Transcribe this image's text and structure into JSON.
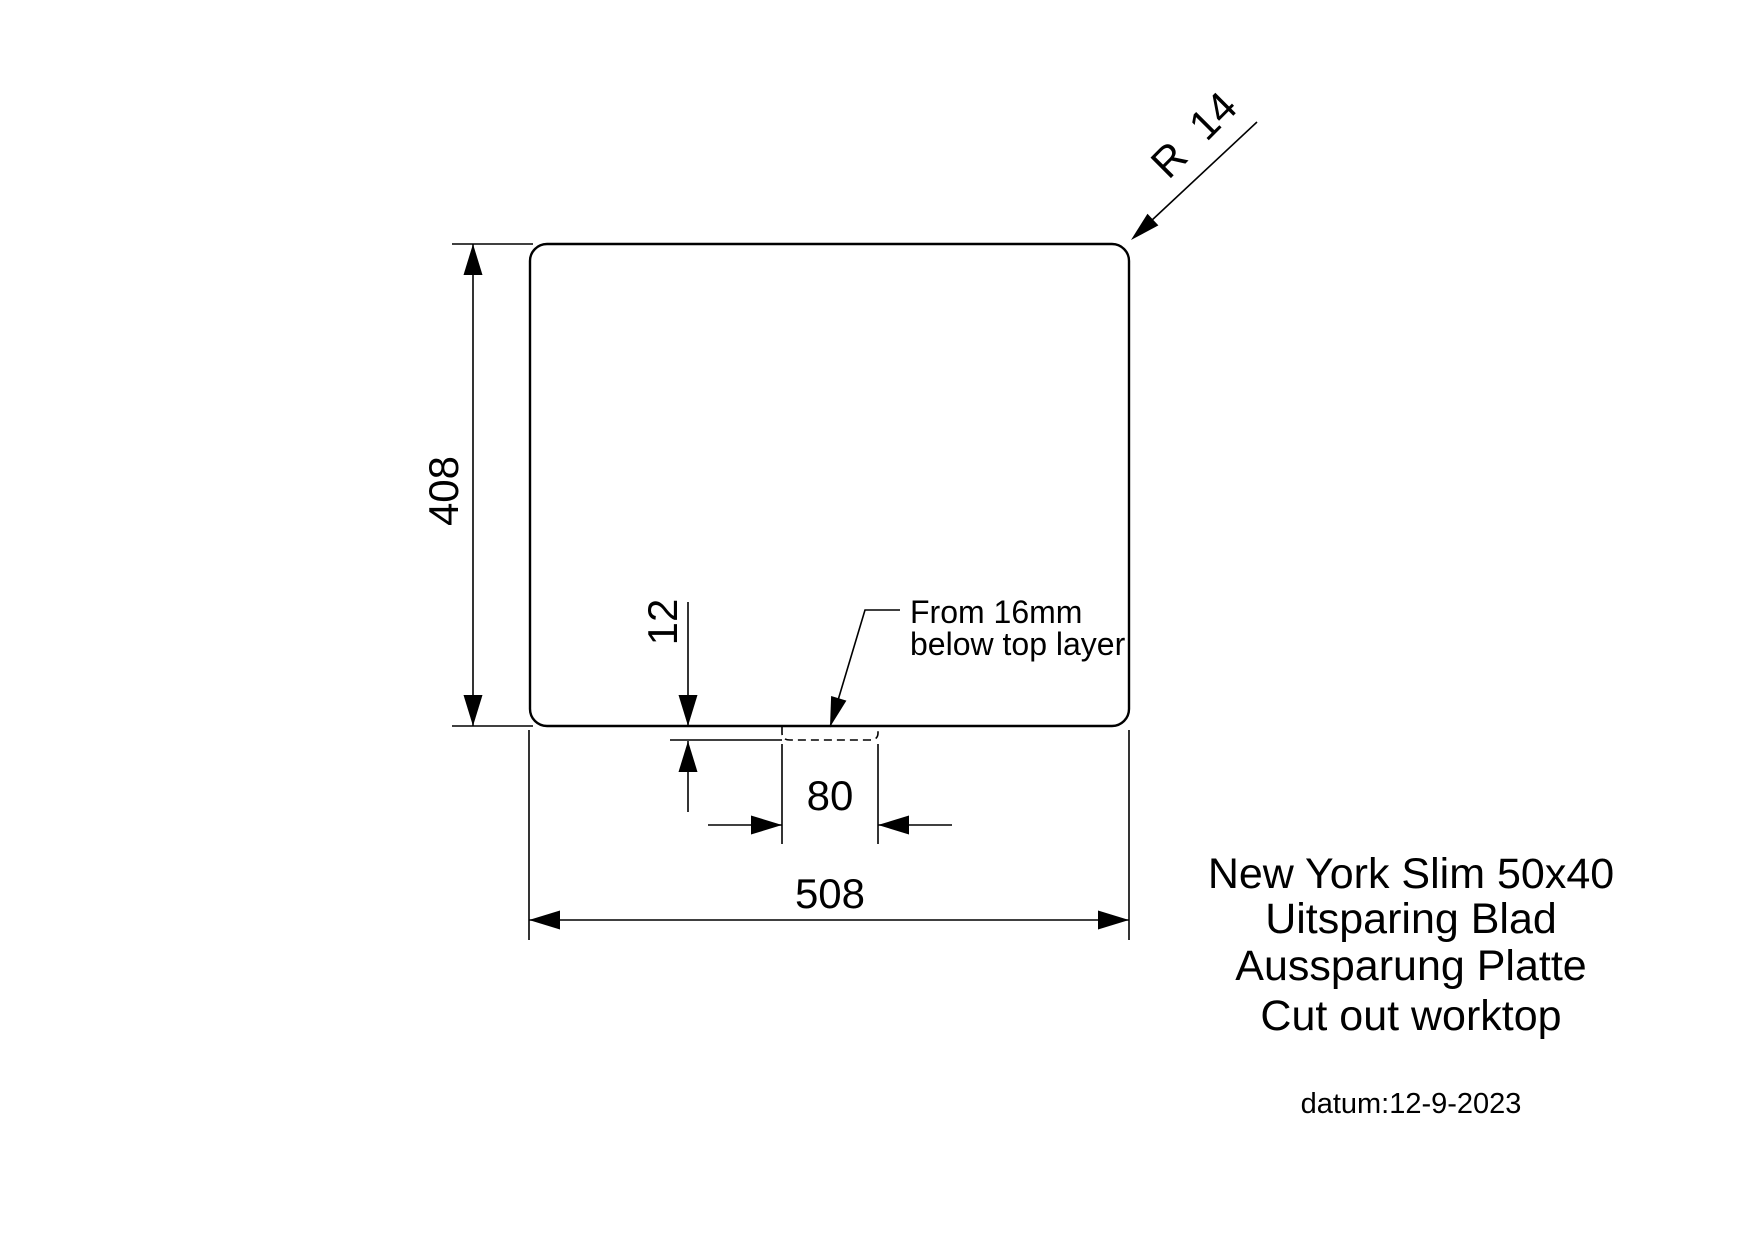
{
  "drawing": {
    "colors": {
      "line": "#000000",
      "background": "#ffffff"
    },
    "dims": {
      "height": "408",
      "width": "508",
      "notch_width": "80",
      "notch_depth": "12",
      "corner_radius": "R  14"
    },
    "note": {
      "line1": "From 16mm",
      "line2": "below top layer"
    },
    "title": {
      "product": "New York Slim 50x40",
      "nl": "Uitsparing Blad",
      "de": "Aussparung Platte",
      "en": "Cut out worktop",
      "date": "datum:12-9-2023"
    }
  }
}
